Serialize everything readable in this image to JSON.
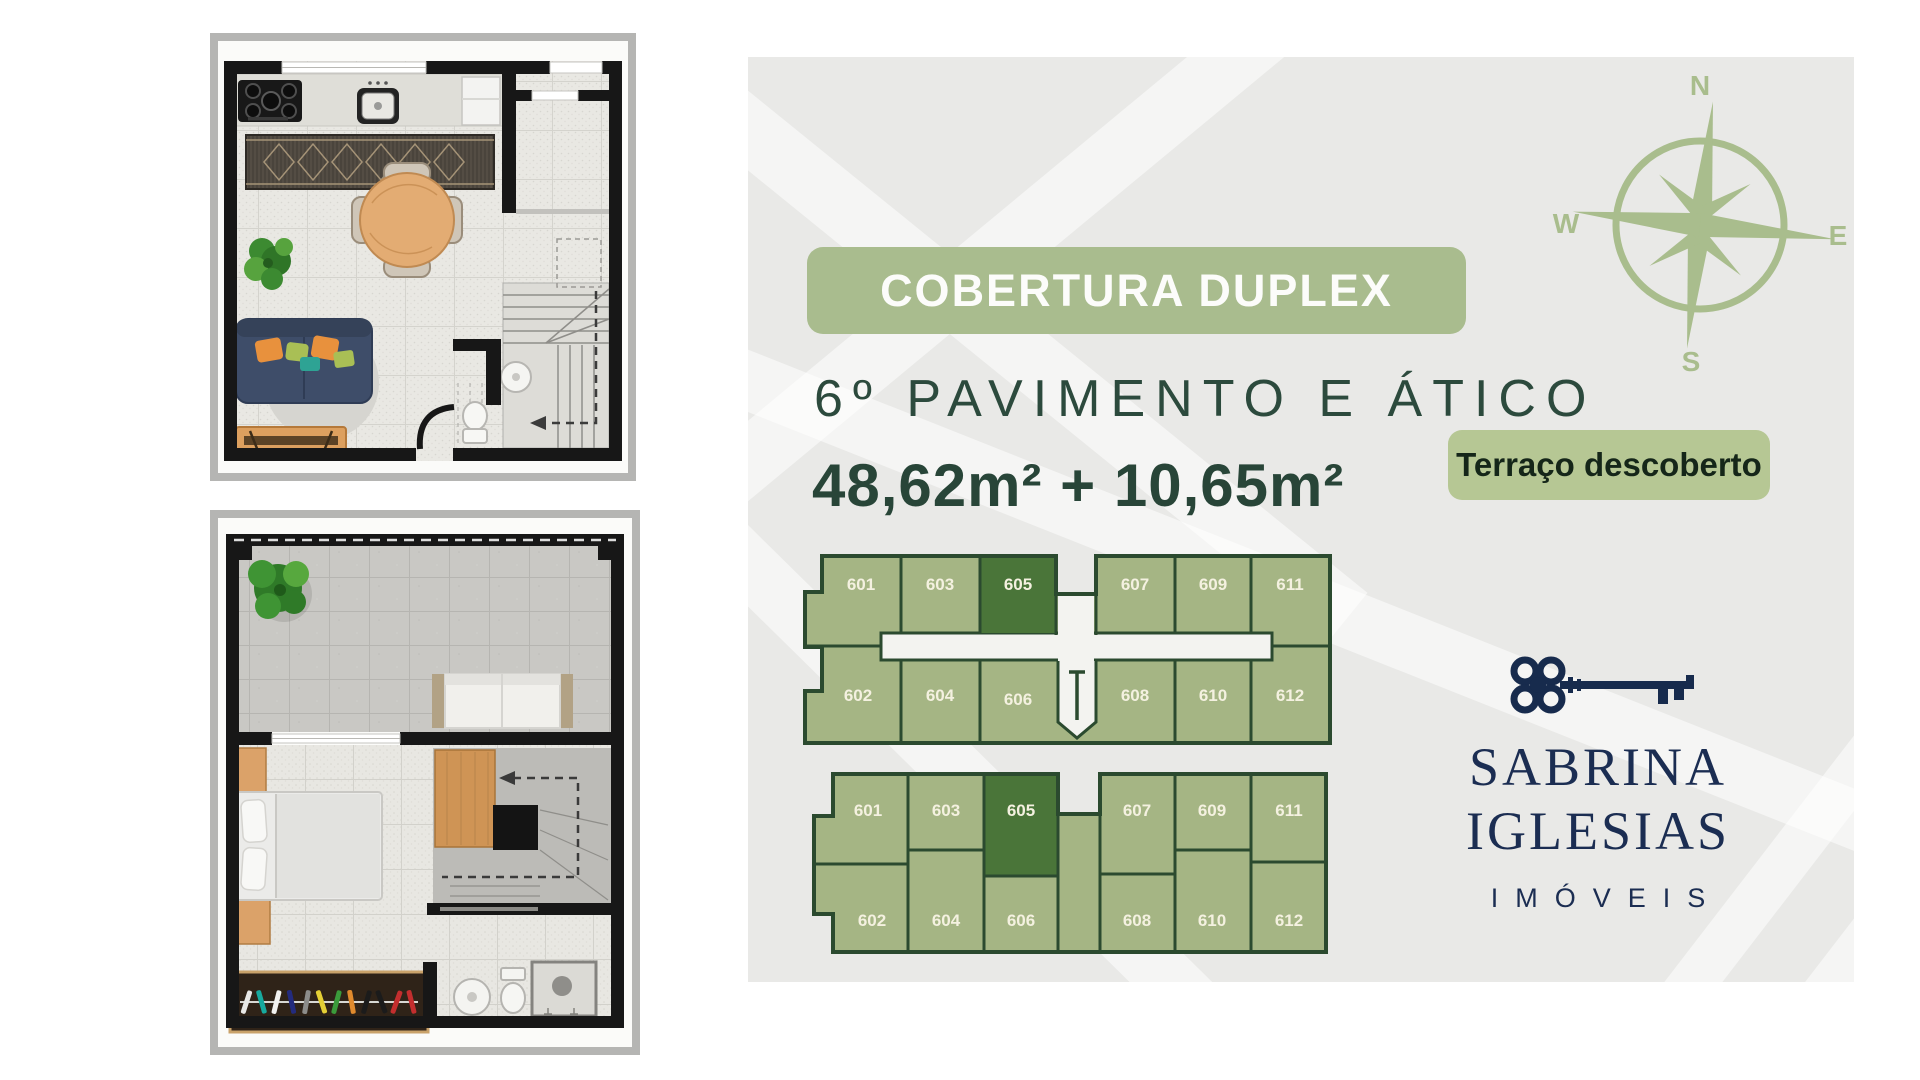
{
  "colors": {
    "panel_bg": "#e9e9e7",
    "watermark": "#ffffff",
    "sage": "#a9bc8e",
    "sage_light": "#b6c794",
    "compass_green": "#a9bd8d",
    "dark_green_text": "#2c4a3d",
    "area_text_green": "#284538",
    "badge_text": "#fcfcfa",
    "terrace_badge_text": "#152619",
    "cell_fill": "#a5b584",
    "cell_highlight": "#4a7539",
    "cell_border": "#2b4a2f",
    "cell_label": "#f4f1e0",
    "brand_navy": "#1b2d52"
  },
  "header": {
    "title_badge": "COBERTURA DUPLEX",
    "subtitle": "6º PAVIMENTO E ÁTICO",
    "area_text": "48,62m² + 10,65m²",
    "terrace_badge": "Terraço descoberto"
  },
  "compass": {
    "north": "N",
    "east": "E",
    "south": "S",
    "west": "W"
  },
  "key_plans": {
    "floor6": {
      "row1": [
        "601",
        "603",
        "605",
        "607",
        "609",
        "611"
      ],
      "row2": [
        "602",
        "604",
        "606",
        "608",
        "610",
        "612"
      ],
      "highlighted_unit": "605"
    },
    "atico": {
      "row1": [
        "601",
        "603",
        "605",
        "607",
        "609",
        "611"
      ],
      "row2": [
        "602",
        "604",
        "606",
        "608",
        "610",
        "612"
      ],
      "highlighted_unit": "605"
    }
  },
  "brand": {
    "name_line1": "SABRINA",
    "name_line2": "IGLESIAS",
    "tagline": "IMÓVEIS"
  }
}
